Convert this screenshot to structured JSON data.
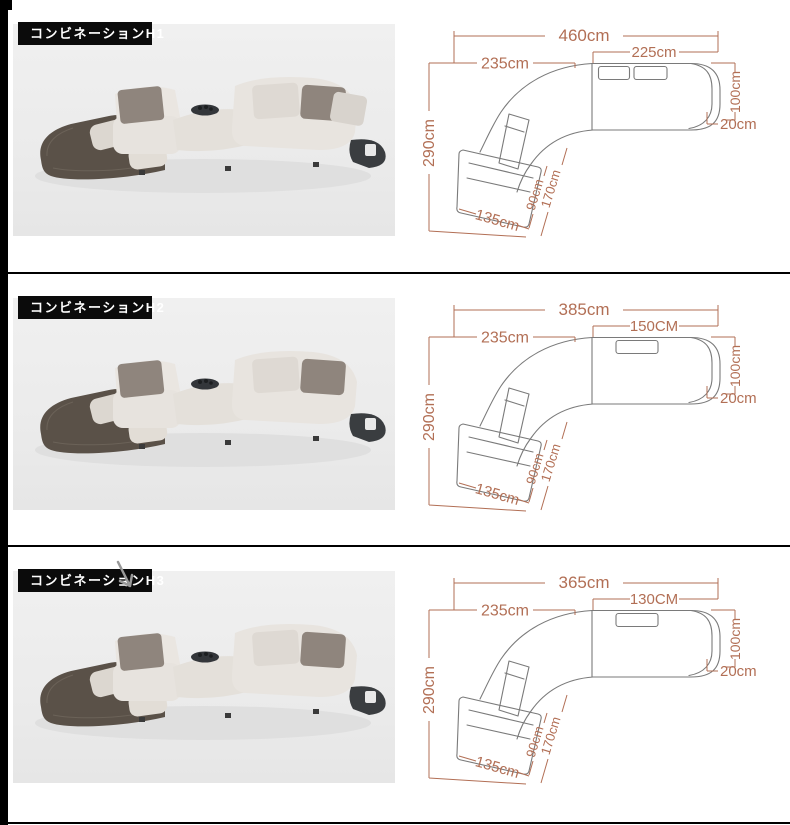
{
  "page": {
    "background": "#ffffff",
    "accent_color": "#b26f55",
    "divider_color": "#000000",
    "card_background": "#ececec",
    "label_background": "#0b0b0b",
    "label_text_color": "#ffffff"
  },
  "rows": [
    {
      "label": "コンビネーションH1",
      "dims": {
        "total_width": "460cm",
        "right_section_width": "225cm",
        "left_section_width": "235cm",
        "overall_depth": "290cm",
        "back_height": "100cm",
        "armrest_width": "20cm",
        "chaise_width": "135cm",
        "chaise_seat_depth": "90cm",
        "chaise_length": "170cm"
      }
    },
    {
      "label": "コンビネーションH2",
      "dims": {
        "total_width": "385cm",
        "right_section_width": "150CM",
        "left_section_width": "235cm",
        "overall_depth": "290cm",
        "back_height": "100cm",
        "armrest_width": "20cm",
        "chaise_width": "135cm",
        "chaise_seat_depth": "90cm",
        "chaise_length": "170cm"
      }
    },
    {
      "label": "コンビネーションH3",
      "dims": {
        "total_width": "365cm",
        "right_section_width": "130CM",
        "left_section_width": "235cm",
        "overall_depth": "290cm",
        "back_height": "100cm",
        "armrest_width": "20cm",
        "chaise_width": "135cm",
        "chaise_seat_depth": "90cm",
        "chaise_length": "170cm"
      }
    }
  ]
}
